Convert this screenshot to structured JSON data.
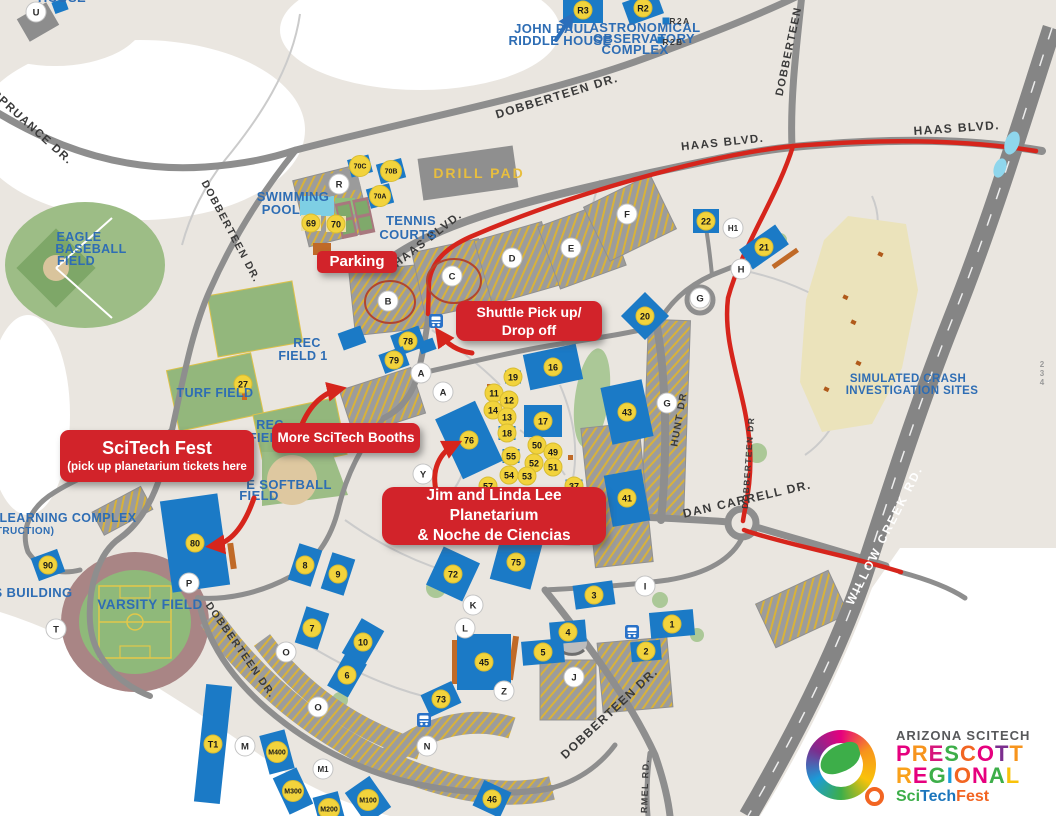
{
  "colors": {
    "building_blue": "#1B7AC6",
    "marker_yellow": "#F2D33C",
    "route_red": "#D6251C",
    "callout_red": "#D2232A",
    "land_cream": "#EAE6E0",
    "road_gray": "#8E8E8E",
    "field_green": "#93B77C",
    "label_blue": "#2E6DB4",
    "crash_khaki": "#EBE3BB"
  },
  "callouts": {
    "parking": {
      "label": "Parking"
    },
    "shuttle": {
      "line1": "Shuttle Pick up/",
      "line2": "Drop off"
    },
    "scitech_fest": {
      "line1": "SciTech Fest",
      "line2": "(pick up planetarium tickets here"
    },
    "more_booths": {
      "label": "More SciTech Booths"
    },
    "planetarium": {
      "line1": "Jim and Linda Lee Planetarium",
      "line2": "& Noche de Ciencias"
    }
  },
  "logo": {
    "line1": "ARIZONA SCITECH",
    "line2": "PRESCOTT",
    "line2_colors": [
      "#E6007E",
      "#F7941D",
      "#D6177B",
      "#3DAE49",
      "#F26522",
      "#E6007E",
      "#7B2E8E",
      "#F7941D"
    ],
    "line3": "REGIONAL",
    "line3_colors": [
      "#F9A11B",
      "#E6007E",
      "#3DAE49",
      "#1B9CD8",
      "#F26522",
      "#E6007E",
      "#3DAE49",
      "#F9C20A"
    ],
    "line4": [
      {
        "text": "Sci",
        "color": "#3DAE49"
      },
      {
        "text": "Tech",
        "color": "#1B75BC"
      },
      {
        "text": "Fest",
        "color": "#F26522"
      }
    ]
  },
  "map": {
    "road_labels": [
      [
        "SPRUANCE DR.",
        30,
        130,
        42,
        11.5,
        "dark"
      ],
      [
        "DOBBERTEEN DR.",
        558,
        100,
        -17,
        12,
        "dark"
      ],
      [
        "DOBBERTEEN",
        792,
        52,
        -78,
        11,
        "dark"
      ],
      [
        "HAAS BLVD.",
        723,
        146,
        -6,
        11.5,
        "dark"
      ],
      [
        "HAAS BLVD.",
        957,
        132,
        -4,
        12,
        "dark"
      ],
      [
        "HAAS BLVD.",
        430,
        242,
        -38,
        11.5,
        "dark"
      ],
      [
        "DOBBERTEEN DR.",
        228,
        233,
        62,
        10.5,
        "dark"
      ],
      [
        "DOBBERTEEN DR.",
        238,
        652,
        55,
        10.5,
        "dark"
      ],
      [
        "DOBBERTEEN DR.",
        612,
        716,
        -43,
        12,
        "dark"
      ],
      [
        "DAN CARRELL DR.",
        748,
        503,
        -13,
        12,
        "dark"
      ],
      [
        "HUNT DR",
        682,
        420,
        -80,
        10,
        "dark"
      ],
      [
        "DOBBERTEEN DR",
        751,
        463,
        -86,
        8.5,
        "dark"
      ],
      [
        "WILLOW CREEK RD.",
        888,
        537,
        -63,
        12,
        "white"
      ],
      [
        "RMEL RD.",
        648,
        786,
        -88,
        9,
        "dark"
      ]
    ],
    "area_labels": [
      [
        "SWIMMING",
        293,
        201,
        0,
        13,
        "blue"
      ],
      [
        "POOL",
        281,
        214,
        0,
        13,
        "blue"
      ],
      [
        "TENNIS",
        411,
        225,
        0,
        13,
        "blue"
      ],
      [
        "COURTS",
        408,
        239,
        0,
        13,
        "blue"
      ],
      [
        "DRILL PAD",
        479,
        178,
        0,
        14,
        "yellow"
      ],
      [
        "EAGLE",
        79,
        241,
        0,
        12.5,
        "blue"
      ],
      [
        "BASEBALL",
        91,
        253,
        0,
        12.5,
        "blue"
      ],
      [
        "FIELD",
        76,
        265,
        0,
        12.5,
        "blue"
      ],
      [
        "REC",
        307,
        347,
        0,
        12.5,
        "blue"
      ],
      [
        "FIELD 1",
        303,
        360,
        0,
        12.5,
        "blue"
      ],
      [
        "TURF FIELD",
        215,
        397,
        0,
        12.5,
        "blue"
      ],
      [
        "REC",
        270,
        429,
        0,
        12.5,
        "blue"
      ],
      [
        "FIELD",
        268,
        442,
        0,
        12.5,
        "blue"
      ],
      [
        "E SOFTBALL",
        289,
        489,
        0,
        13,
        "blue"
      ],
      [
        "FIELD",
        259,
        500,
        0,
        13,
        "blue"
      ],
      [
        "VARSITY FIELD",
        150,
        609,
        0,
        13.5,
        "blue"
      ],
      [
        "LEARNING COMPLEX",
        68,
        522,
        0,
        12.5,
        "blue"
      ],
      [
        "(CONSTRUCTION)",
        8,
        534,
        0,
        10,
        "blue"
      ],
      [
        "S BUILDING",
        33,
        597,
        0,
        13,
        "blue"
      ],
      [
        "JOHN PAUL",
        553,
        33,
        0,
        13,
        "blue"
      ],
      [
        "RIDDLE HOUSE",
        560,
        45,
        0,
        13,
        "blue"
      ],
      [
        "ASTRONOMICAL",
        645,
        32,
        0,
        13,
        "blue"
      ],
      [
        "OBSERVATORY",
        644,
        43,
        0,
        13,
        "blue"
      ],
      [
        "COMPLEX",
        635,
        54,
        0,
        13,
        "blue"
      ],
      [
        "SIMULATED CRASH",
        908,
        382,
        0,
        11.5,
        "blue"
      ],
      [
        "INVESTIGATION SITES",
        912,
        394,
        0,
        11.5,
        "blue"
      ],
      [
        "HOUSE",
        62,
        2,
        0,
        13,
        "blue"
      ]
    ],
    "small_labels": [
      [
        "R2A",
        680,
        24,
        0,
        8.5,
        "dark"
      ],
      [
        "R2B",
        673,
        45,
        0,
        8.5,
        "dark"
      ],
      [
        "2",
        1042,
        367,
        0,
        8,
        "gray"
      ],
      [
        "3",
        1042,
        376,
        0,
        8,
        "gray"
      ],
      [
        "4",
        1042,
        385,
        0,
        8,
        "gray"
      ]
    ],
    "buildings": [
      [
        583,
        10,
        40,
        26,
        0,
        "R3",
        null
      ],
      [
        643,
        8,
        36,
        24,
        -20,
        "R2",
        null
      ],
      [
        666,
        21,
        7,
        7,
        0,
        null,
        null
      ],
      [
        661,
        40,
        7,
        7,
        0,
        null,
        null
      ],
      [
        60,
        6,
        14,
        12,
        -20,
        null,
        null
      ],
      [
        38,
        22,
        34,
        26,
        -30,
        null,
        "#8D8D8D"
      ],
      [
        342,
        182,
        34,
        22,
        -15,
        null,
        "#9B9B9B"
      ],
      [
        360,
        166,
        22,
        18,
        -15,
        "70C",
        null
      ],
      [
        391,
        171,
        26,
        20,
        -15,
        "70B",
        null
      ],
      [
        380,
        196,
        24,
        20,
        -15,
        "70A",
        null
      ],
      [
        311,
        223,
        20,
        16,
        0,
        "69",
        "#EADFAE"
      ],
      [
        336,
        224,
        20,
        16,
        0,
        "70",
        "#EADFAE"
      ],
      [
        322,
        249,
        18,
        12,
        0,
        null,
        "#C06A28"
      ],
      [
        352,
        338,
        24,
        18,
        -20,
        null,
        null
      ],
      [
        427,
        346,
        16,
        12,
        -20,
        null,
        null
      ],
      [
        408,
        341,
        30,
        22,
        -20,
        "78",
        null
      ],
      [
        394,
        360,
        26,
        20,
        -20,
        "79",
        null
      ],
      [
        645,
        316,
        34,
        34,
        45,
        "20",
        null
      ],
      [
        553,
        367,
        54,
        36,
        -12,
        "16",
        null
      ],
      [
        513,
        377,
        16,
        13,
        0,
        "19",
        null
      ],
      [
        494,
        393,
        15,
        12,
        0,
        "11",
        null
      ],
      [
        509,
        400,
        15,
        12,
        0,
        "12",
        null
      ],
      [
        493,
        410,
        15,
        12,
        0,
        "14",
        null
      ],
      [
        507,
        417,
        15,
        12,
        0,
        "13",
        null
      ],
      [
        543,
        421,
        38,
        32,
        0,
        "17",
        null
      ],
      [
        507,
        433,
        17,
        14,
        0,
        "18",
        null
      ],
      [
        469,
        440,
        44,
        66,
        -25,
        "76",
        null
      ],
      [
        537,
        445,
        15,
        12,
        0,
        "50",
        null
      ],
      [
        511,
        456,
        17,
        14,
        0,
        "55",
        null
      ],
      [
        553,
        452,
        15,
        12,
        0,
        "49",
        null
      ],
      [
        534,
        463,
        15,
        12,
        0,
        "52",
        null
      ],
      [
        553,
        467,
        15,
        12,
        0,
        "51",
        null
      ],
      [
        509,
        475,
        15,
        12,
        0,
        "54",
        null
      ],
      [
        527,
        476,
        15,
        12,
        0,
        "53",
        null
      ],
      [
        488,
        486,
        14,
        11,
        0,
        "57",
        null
      ],
      [
        574,
        486,
        17,
        13,
        0,
        "37",
        null
      ],
      [
        627,
        412,
        42,
        58,
        -12,
        "43",
        null
      ],
      [
        627,
        498,
        38,
        52,
        -10,
        "41",
        null
      ],
      [
        706,
        221,
        26,
        24,
        0,
        "22",
        null
      ],
      [
        764,
        247,
        44,
        24,
        -35,
        "21",
        null
      ],
      [
        243,
        384,
        14,
        12,
        -10,
        "27",
        "#9B9B9B"
      ],
      [
        195,
        543,
        58,
        92,
        -8,
        "80",
        null
      ],
      [
        48,
        565,
        28,
        24,
        -20,
        "90",
        null
      ],
      [
        305,
        565,
        24,
        38,
        18,
        "8",
        null
      ],
      [
        338,
        574,
        24,
        38,
        18,
        "9",
        null
      ],
      [
        312,
        628,
        24,
        38,
        18,
        "7",
        null
      ],
      [
        363,
        642,
        26,
        40,
        30,
        "10",
        null
      ],
      [
        347,
        675,
        24,
        38,
        30,
        "6",
        null
      ],
      [
        453,
        574,
        40,
        42,
        25,
        "72",
        null
      ],
      [
        516,
        562,
        42,
        46,
        15,
        "75",
        null
      ],
      [
        441,
        699,
        34,
        24,
        -25,
        "73",
        null
      ],
      [
        484,
        662,
        54,
        56,
        0,
        "45",
        null
      ],
      [
        492,
        799,
        30,
        28,
        25,
        "46",
        null
      ],
      [
        543,
        652,
        42,
        24,
        -5,
        "5",
        null
      ],
      [
        568,
        632,
        36,
        22,
        -5,
        "4",
        null
      ],
      [
        594,
        595,
        40,
        24,
        -8,
        "3",
        null
      ],
      [
        672,
        624,
        44,
        26,
        -5,
        "1",
        null
      ],
      [
        646,
        651,
        30,
        20,
        -5,
        "2",
        null
      ],
      [
        213,
        744,
        26,
        118,
        6,
        "T1",
        null
      ],
      [
        277,
        752,
        26,
        40,
        -15,
        "M400",
        null
      ],
      [
        293,
        791,
        26,
        40,
        -25,
        "M300",
        null
      ],
      [
        329,
        809,
        26,
        30,
        -15,
        "M200",
        null
      ],
      [
        368,
        800,
        30,
        38,
        -35,
        "M100",
        null
      ]
    ],
    "circle_markers": [
      [
        36,
        12,
        "U"
      ],
      [
        339,
        184,
        "R"
      ],
      [
        388,
        301,
        "B"
      ],
      [
        452,
        276,
        "C"
      ],
      [
        512,
        258,
        "D"
      ],
      [
        571,
        248,
        "E"
      ],
      [
        627,
        214,
        "F"
      ],
      [
        421,
        373,
        "A"
      ],
      [
        443,
        392,
        "A"
      ],
      [
        423,
        474,
        "Y"
      ],
      [
        667,
        403,
        "G"
      ],
      [
        700,
        298,
        "G"
      ],
      [
        741,
        269,
        "H"
      ],
      [
        733,
        228,
        "H1"
      ],
      [
        473,
        605,
        "K"
      ],
      [
        465,
        628,
        "L"
      ],
      [
        504,
        691,
        "Z"
      ],
      [
        645,
        586,
        "I"
      ],
      [
        574,
        677,
        "J"
      ],
      [
        245,
        746,
        "M"
      ],
      [
        427,
        746,
        "N"
      ],
      [
        286,
        652,
        "O"
      ],
      [
        318,
        707,
        "O"
      ],
      [
        189,
        583,
        "P"
      ],
      [
        56,
        629,
        "T"
      ],
      [
        323,
        769,
        "M1"
      ]
    ],
    "bus_stops": [
      [
        436,
        321
      ],
      [
        424,
        720
      ],
      [
        632,
        632
      ]
    ]
  }
}
